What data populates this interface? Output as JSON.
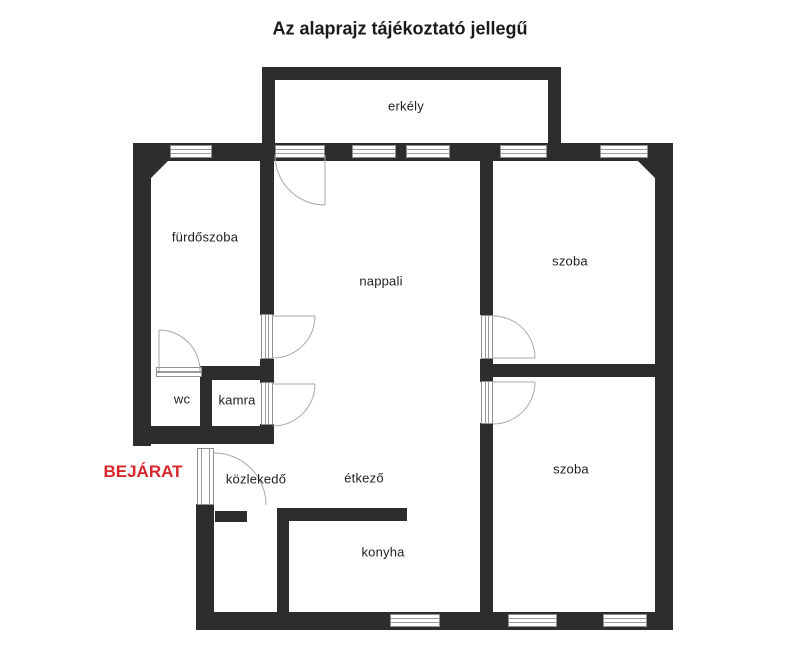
{
  "labels": {
    "title": "Az alaprajz tájékoztató jellegű",
    "balcony": "erkély",
    "bathroom": "fürdőszoba",
    "living_room": "nappali",
    "room_top": "szoba",
    "room_bottom": "szoba",
    "wc": "wc",
    "pantry": "kamra",
    "entrance": "BEJÁRAT",
    "hallway": "közlekedő",
    "dining": "étkező",
    "kitchen": "konyha"
  },
  "colors": {
    "wall": "#2d2d2d",
    "entrance_red": "#d8262c"
  }
}
